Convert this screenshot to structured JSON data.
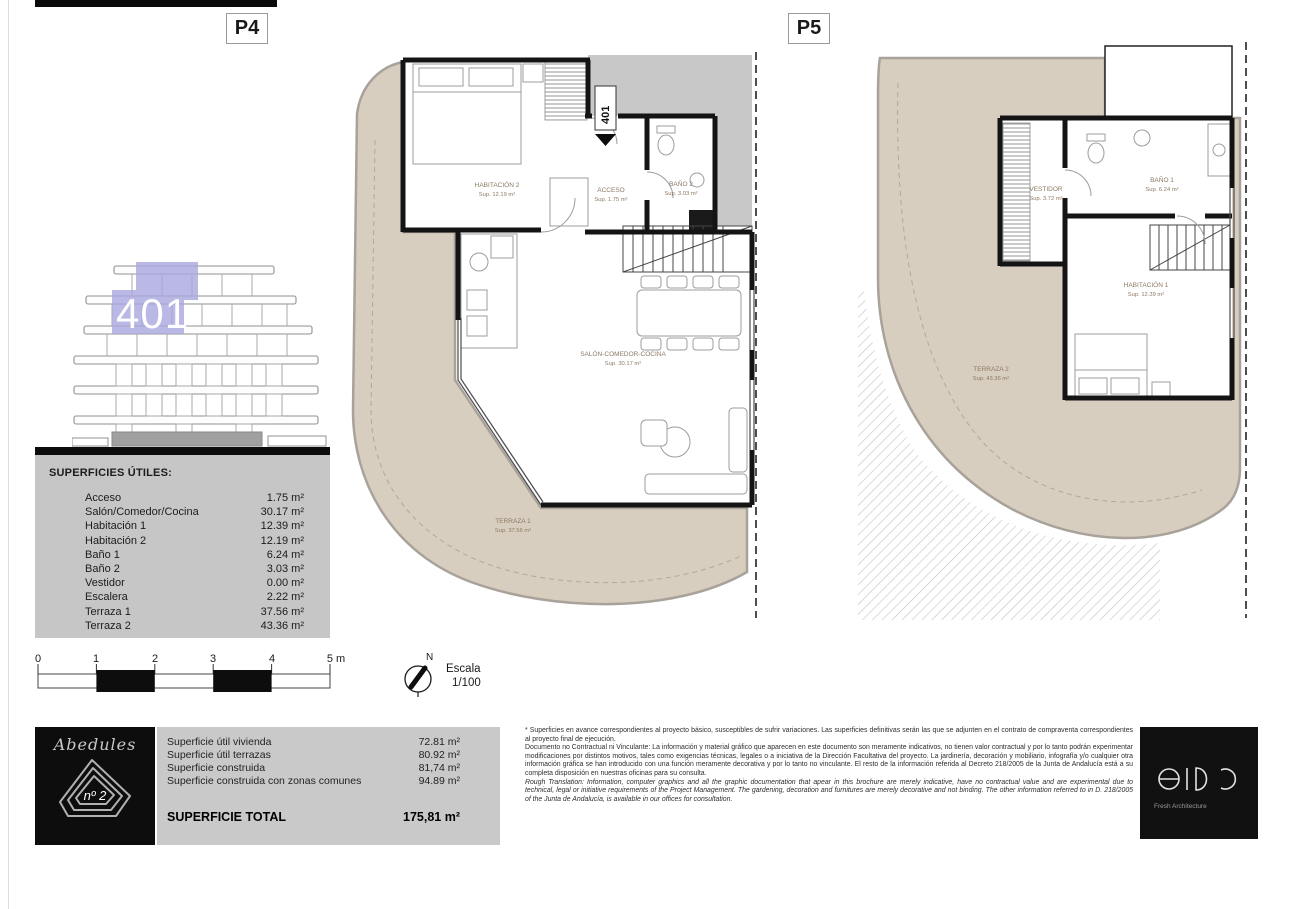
{
  "page": {
    "p4_label": "P4",
    "p5_label": "P5"
  },
  "colors": {
    "terrace_beige": "#d8cebf",
    "common_gray": "#c8c8c8",
    "panel_gray": "#c6c6c6",
    "highlight_lavender": "#a9a8e0"
  },
  "elevation": {
    "unit_number": "401"
  },
  "plan_p4": {
    "entrance_tag": "401",
    "rooms": {
      "habitacion2": {
        "name": "HABITACIÓN 2",
        "sup": "Sup. 12.19 m²"
      },
      "acceso": {
        "name": "ACCESO",
        "sup": "Sup. 1.75 m²"
      },
      "bano2": {
        "name": "BAÑO 2",
        "sup": "Sup. 3.03 m²"
      },
      "salon": {
        "name": "SALÓN-COMEDOR-COCINA",
        "sup": "Sup. 30.17 m²"
      },
      "terraza1": {
        "name": "TERRAZA 1",
        "sup": "Sup. 37.56 m²"
      }
    }
  },
  "plan_p5": {
    "rooms": {
      "vestidor": {
        "name": "VESTIDOR",
        "sup": "Sup. 3.72 m²"
      },
      "bano1": {
        "name": "BAÑO 1",
        "sup": "Sup. 6.24 m²"
      },
      "habitacion1": {
        "name": "HABITACIÓN 1",
        "sup": "Sup. 12.39 m²"
      },
      "terraza2": {
        "name": "TERRAZA 2",
        "sup": "Sup. 43.36 m²"
      }
    }
  },
  "superficies": {
    "title": "SUPERFICIES ÚTILES:",
    "rows": [
      {
        "label": "Acceso",
        "value": "1.75 m²"
      },
      {
        "label": "Salón/Comedor/Cocina",
        "value": "30.17 m²"
      },
      {
        "label": "Habitación 1",
        "value": "12.39 m²"
      },
      {
        "label": "Habitación 2",
        "value": "12.19 m²"
      },
      {
        "label": "Baño 1",
        "value": "6.24 m²"
      },
      {
        "label": "Baño 2",
        "value": "3.03 m²"
      },
      {
        "label": "Vestidor",
        "value": "0.00 m²"
      },
      {
        "label": "Escalera",
        "value": "2.22 m²"
      },
      {
        "label": "Terraza 1",
        "value": "37.56 m²"
      },
      {
        "label": "Terraza 2",
        "value": "43.36 m²"
      }
    ]
  },
  "scale_bar": {
    "ticks": [
      "0",
      "1",
      "2",
      "3",
      "4",
      "5 m"
    ]
  },
  "compass": {
    "north": "N",
    "escala_line1": "Escala",
    "escala_line2": "1/100"
  },
  "footer": {
    "project": {
      "name": "Abedules",
      "number": "nº 2"
    },
    "summary": {
      "rows": [
        {
          "label": "Superficie útil vivienda",
          "value": "72.81 m²"
        },
        {
          "label": "Superficie útil terrazas",
          "value": "80.92 m²"
        },
        {
          "label": "Superficie construida",
          "value": "81,74 m²"
        },
        {
          "label": "Superficie construida con zonas comunes",
          "value": "94.89 m²"
        }
      ],
      "total_label": "SUPERFICIE TOTAL",
      "total_value": "175,81 m²"
    },
    "disclaimer": {
      "p1": "* Superficies en avance correspondientes al proyecto básico, susceptibles de sufrir variaciones. Las superficies definitivas serán las que se adjunten en el contrato de compraventa correspondientes al proyecto final de ejecución.",
      "p2": "Documento no Contractual ni Vinculante: La información y material gráfico que aparecen en este documento son meramente indicativos, no tienen valor contractual y por lo tanto podrán experimentar modificaciones por distintos motivos, tales como exigencias técnicas, legales o a iniciativa de la Dirección Facultativa del proyecto. La jardinería, decoración y mobiliario, infografía y/o cualquier otra información gráfica se han introducido con una función meramente decorativa y por lo tanto no vinculante. El resto de la información referida al Decreto 218/2005 de la Junta de Andalucía está a su completa disposición en nuestras oficinas para su consulta.",
      "p3": "Rough Translation: Information, computer graphics and all the graphic documentation that apear in this brochure are merely indicative, have no contractual value and are experimental due to technical, legal or initiative requirements of the Project Management. The gardening, decoration and furnitures are merely decorative and not binding. The other information referred to in D. 218/2005 of the Junta de Andalucía, is available in our offices for consultation."
    },
    "architect": {
      "name": "eido",
      "tagline": "Fresh Architecture"
    }
  }
}
